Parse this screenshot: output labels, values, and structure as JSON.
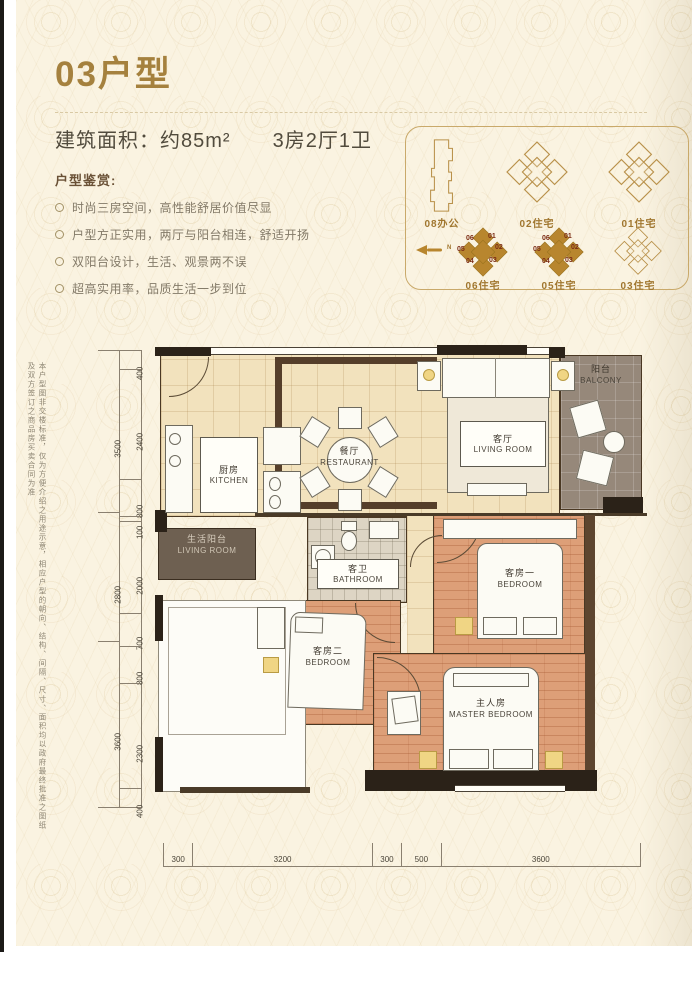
{
  "page": {
    "title": "03户型",
    "area_label": "建筑面积：约85m²",
    "layout_label": "3房2厅1卫",
    "features_heading": "户型鉴赏:",
    "features": [
      "时尚三房空间，高性能舒居价值尽显",
      "户型方正实用，两厅与阳台相连，舒适开扬",
      "双阳台设计，生活、观景两不误",
      "超高实用率，品质生活一步到位"
    ],
    "disclaimer": "本户型图非交楼标准，仅为方便介绍之用途示意，相应户型的朝向、结构、间隔、尺寸、面积均以政府最终批准之图纸及双方签订之商品房买卖合同为准"
  },
  "site_plan": {
    "compass_label": "N",
    "buildings": [
      {
        "label": "08办公"
      },
      {
        "label": "02住宅"
      },
      {
        "label": "01住宅"
      },
      {
        "label": "06住宅"
      },
      {
        "label": "05住宅"
      },
      {
        "label": "03住宅"
      }
    ],
    "units": [
      "06",
      "01",
      "05",
      "02",
      "04",
      "03"
    ]
  },
  "floor_plan": {
    "rooms": {
      "kitchen": {
        "cn": "厨房",
        "en": "KITCHEN"
      },
      "dining": {
        "cn": "餐厅",
        "en": "RESTAURANT"
      },
      "living": {
        "cn": "客厅",
        "en": "LIVING ROOM"
      },
      "balcony": {
        "cn": "阳台",
        "en": "BALCONY"
      },
      "service_balcony": {
        "cn": "生活阳台",
        "en": "LIVING ROOM"
      },
      "bathroom": {
        "cn": "客卫",
        "en": "BATHROOM"
      },
      "bedroom1": {
        "cn": "客房一",
        "en": "BEDROOM"
      },
      "bedroom2": {
        "cn": "客房二",
        "en": "BEDROOM"
      },
      "master": {
        "cn": "主人房",
        "en": "MASTER BEDROOM"
      }
    },
    "dimensions": {
      "left_outer": [
        "3500",
        "2800",
        "3600"
      ],
      "left_inner": [
        "400",
        "2400",
        "800",
        "100",
        "2000",
        "700",
        "800",
        "2300",
        "400"
      ],
      "bottom": [
        "300",
        "3200",
        "300",
        "500",
        "3600"
      ]
    }
  },
  "colors": {
    "accent_gold": "#a5813e",
    "building_fill": "#b8862e",
    "floor_cream": "#f2e2bd",
    "floor_salmon": "#dd9f78",
    "balcony_taupe": "#96887a",
    "wall_dark": "#2b2218"
  }
}
